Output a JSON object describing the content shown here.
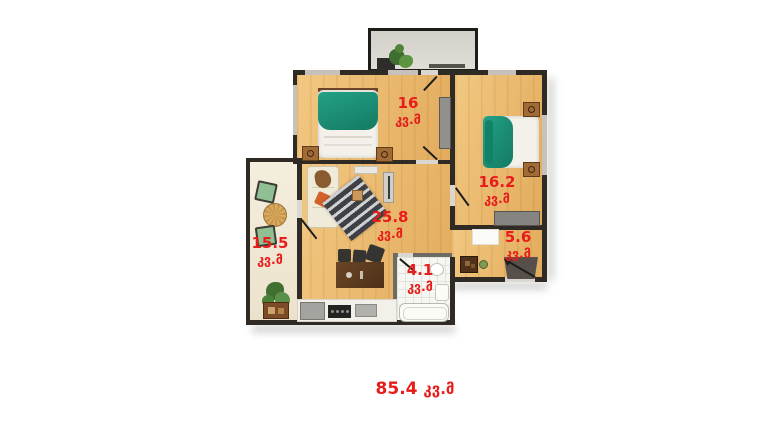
{
  "plan": {
    "unit_label": "კვ.მ",
    "total_area": "85.4",
    "rooms": [
      {
        "name": "bedroom-top-left",
        "area": "16"
      },
      {
        "name": "bedroom-right",
        "area": "16.2"
      },
      {
        "name": "living-room",
        "area": "25.8"
      },
      {
        "name": "balcony-left",
        "area": "15.5"
      },
      {
        "name": "hallway",
        "area": "5.6"
      },
      {
        "name": "bathroom",
        "area": "4.1"
      }
    ],
    "colors": {
      "label_red": "#e81c1a",
      "wall_dark": "#2f2a24",
      "wood_light": "#f2c882",
      "wood_dark": "#e2ab5c",
      "balcony_floor": "#f2ecdb",
      "bed_teal": "#1e9b80",
      "tile_white": "#f6f6f2"
    }
  }
}
